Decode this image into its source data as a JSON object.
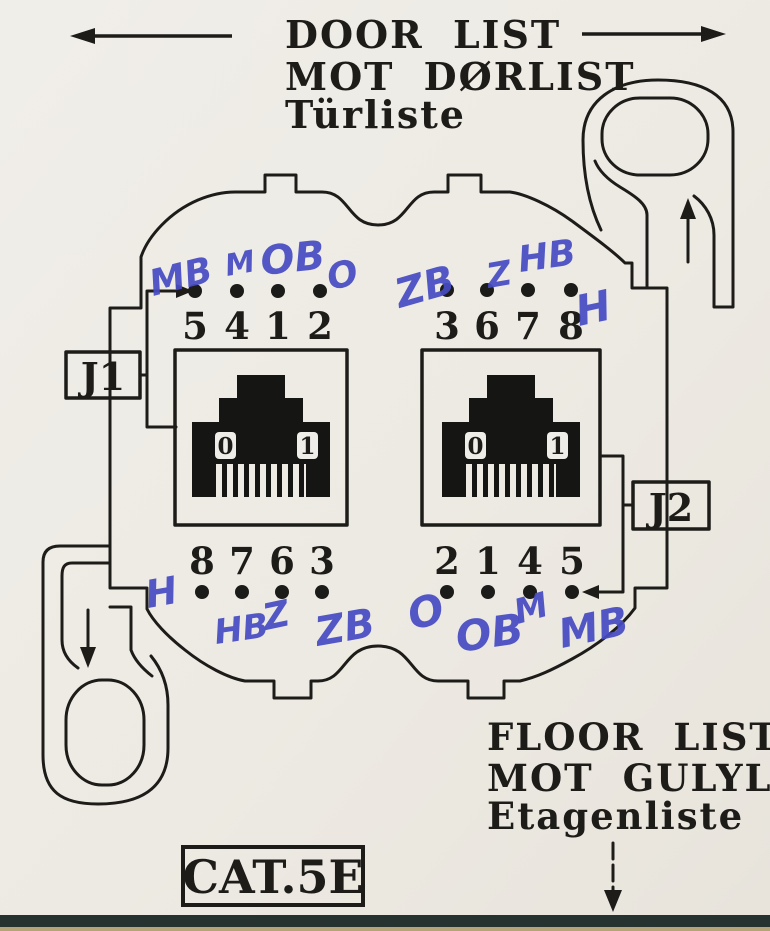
{
  "document": {
    "type": "scanned wiring diagram for CAT.5E wall outlet",
    "standard_label": "CAT.5E"
  },
  "door_side": {
    "line1": "DOOR LIST",
    "line2": "MOT DØRLIST",
    "line3": "Türliste"
  },
  "floor_side": {
    "line1": "FLOOR LIST",
    "line2": "MOT GULYLIST",
    "line3": "Etagenliste"
  },
  "jacks": {
    "j1_label": "J1",
    "j2_label": "J2",
    "window_left_digit": "0",
    "window_right_digit": "1"
  },
  "pins": {
    "top_left": [
      {
        "num": "5",
        "wire": "MB"
      },
      {
        "num": "4",
        "wire": "M"
      },
      {
        "num": "1",
        "wire": "OB"
      },
      {
        "num": "2",
        "wire": "O"
      }
    ],
    "top_right": [
      {
        "num": "3",
        "wire": "ZB"
      },
      {
        "num": "6",
        "wire": "Z"
      },
      {
        "num": "7",
        "wire": "HB"
      },
      {
        "num": "8",
        "wire": "H"
      }
    ],
    "bottom_left": [
      {
        "num": "8",
        "wire": "H"
      },
      {
        "num": "7",
        "wire": "HB"
      },
      {
        "num": "6",
        "wire": "Z"
      },
      {
        "num": "3",
        "wire": "ZB"
      }
    ],
    "bottom_right": [
      {
        "num": "2",
        "wire": "O"
      },
      {
        "num": "1",
        "wire": "OB"
      },
      {
        "num": "4",
        "wire": "M"
      },
      {
        "num": "5",
        "wire": "MB"
      }
    ]
  },
  "colors": {
    "paper": "#edeae3",
    "ink": "#1d1c19",
    "pen_blue": "#474cc3",
    "scan_edge_dark": "#25322f",
    "scan_edge_tan": "#b5a478"
  }
}
